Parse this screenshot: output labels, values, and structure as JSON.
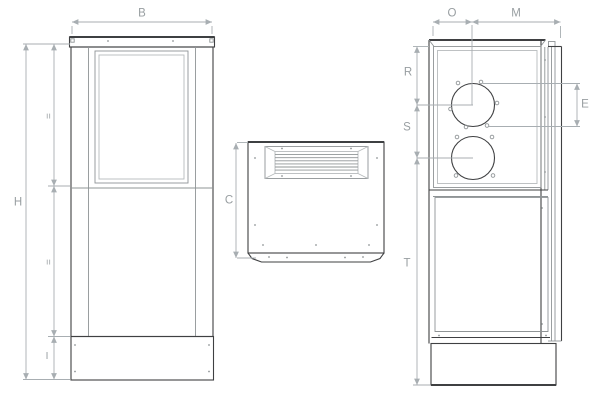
{
  "palette": {
    "outline": "#3f4042",
    "detail": "#8f9496",
    "detail_light": "#b7bbbd",
    "dimension": "#a8aeb2",
    "text": "#989ea1"
  },
  "dim_labels": {
    "front_width": "B",
    "front_height": "H",
    "front_upper_equal": "=",
    "front_lower_equal": "=",
    "front_base_height": "I",
    "panel_height": "C",
    "side_front_depth": "O",
    "side_rear_depth": "M",
    "side_knockout_top_offset": "R",
    "side_knockout_spacing": "S",
    "side_lower_height": "T",
    "side_knockout_diameter": "E"
  }
}
